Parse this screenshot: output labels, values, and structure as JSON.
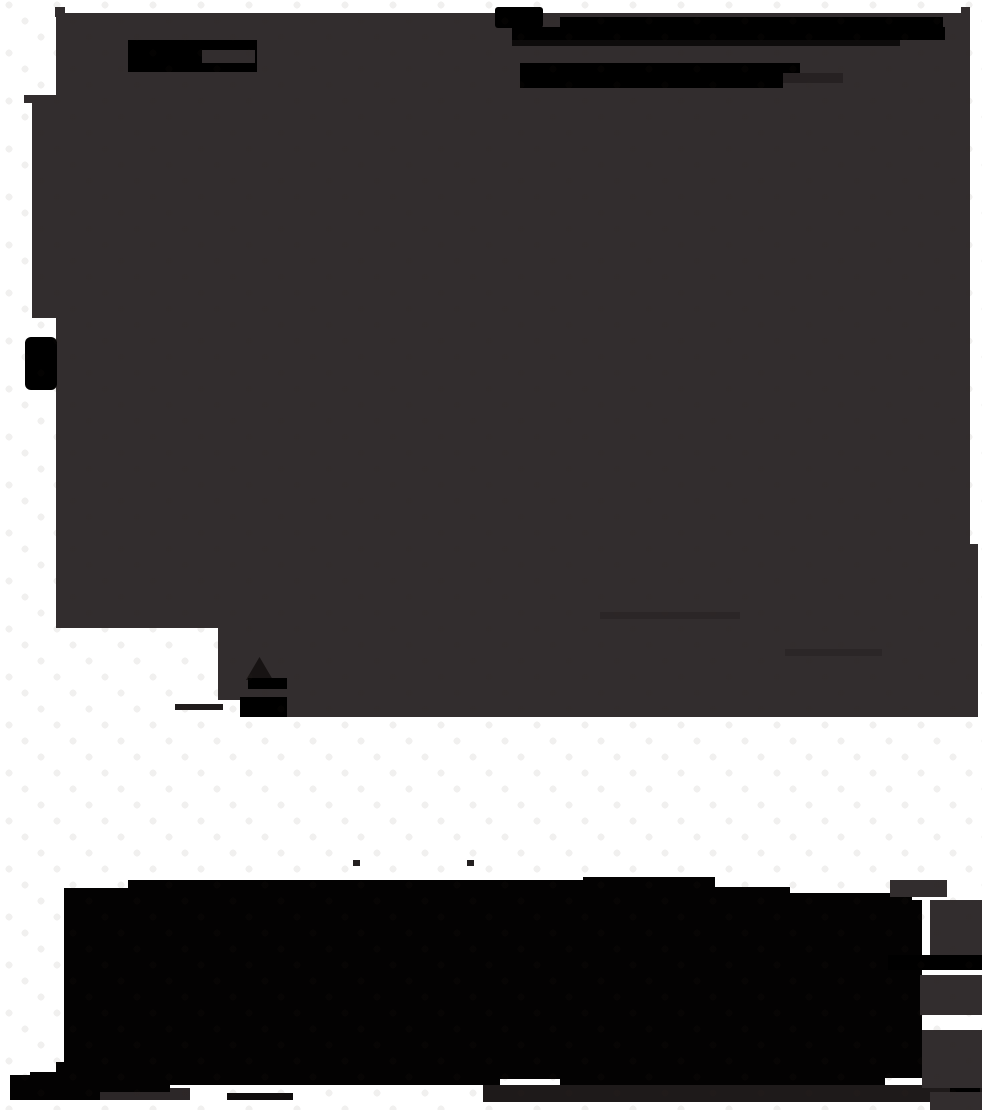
{
  "canvas": {
    "width": 982,
    "height": 1110,
    "background_color": "#ffffff",
    "dot_grid": {
      "cell_width": 48,
      "row_height": 16,
      "dot_diameter": 7,
      "dot_color": "rgba(52,38,26,0.07)"
    }
  },
  "palette": {
    "ink_gray": "#322d2e",
    "ink_black": "#000000",
    "ink_soft_black": "#1e1a1a",
    "canvas_white": "#ffffff"
  },
  "shapes": {
    "rects": [
      {
        "name": "gray-region-main",
        "layer": 1,
        "x": 56,
        "y": 13,
        "w": 914,
        "h": 704,
        "color": "#322d2e"
      },
      {
        "name": "gray-region-right-strip",
        "layer": 1,
        "x": 970,
        "y": 544,
        "w": 8,
        "h": 173,
        "color": "#322d2e"
      },
      {
        "name": "gray-tab-top-right",
        "layer": 1,
        "x": 961,
        "y": 7,
        "w": 9,
        "h": 10,
        "color": "#322d2e"
      },
      {
        "name": "gray-tab-top-left",
        "layer": 1,
        "x": 55,
        "y": 7,
        "w": 10,
        "h": 10,
        "color": "#322d2e"
      },
      {
        "name": "gray-left-strip",
        "layer": 1,
        "x": 32,
        "y": 100,
        "w": 24,
        "h": 218,
        "color": "#322d2e"
      },
      {
        "name": "gray-left-sliver",
        "layer": 1,
        "x": 24,
        "y": 95,
        "w": 32,
        "h": 8,
        "color": "#322d2e"
      },
      {
        "name": "gray-streak-1",
        "layer": 1,
        "x": 600,
        "y": 612,
        "w": 140,
        "h": 7,
        "color": "#2b2627"
      },
      {
        "name": "gray-streak-2",
        "layer": 1,
        "x": 785,
        "y": 649,
        "w": 97,
        "h": 7,
        "color": "#2b2627"
      },
      {
        "name": "white-cutout-bottom-left",
        "layer": 1,
        "x": 56,
        "y": 628,
        "w": 162,
        "h": 89,
        "color": "#ffffff"
      },
      {
        "name": "white-cutout-bottom-left-2",
        "layer": 1,
        "x": 218,
        "y": 700,
        "w": 22,
        "h": 17,
        "color": "#ffffff"
      },
      {
        "name": "gray-underfoot-strip",
        "layer": 1,
        "x": 10,
        "y": 1088,
        "w": 180,
        "h": 12,
        "color": "#2c2728"
      },
      {
        "name": "black-block-top-left",
        "layer": 2,
        "x": 128,
        "y": 40,
        "w": 129,
        "h": 32,
        "color": "#000000"
      },
      {
        "name": "gray-window-in-block",
        "layer": 2,
        "x": 202,
        "y": 50,
        "w": 53,
        "h": 13,
        "color": "#322d2e"
      },
      {
        "name": "black-chunk-top",
        "layer": 2,
        "x": 495,
        "y": 7,
        "w": 48,
        "h": 21,
        "color": "#000000",
        "r": 3
      },
      {
        "name": "black-bar-top-1",
        "layer": 2,
        "x": 560,
        "y": 17,
        "w": 383,
        "h": 11,
        "color": "#000000"
      },
      {
        "name": "black-bar-top-2",
        "layer": 2,
        "x": 512,
        "y": 27,
        "w": 433,
        "h": 13,
        "color": "#000000"
      },
      {
        "name": "black-bar-top-3",
        "layer": 2,
        "x": 512,
        "y": 40,
        "w": 388,
        "h": 6,
        "color": "#0d0b0b"
      },
      {
        "name": "black-bar-mid-1",
        "layer": 2,
        "x": 520,
        "y": 63,
        "w": 280,
        "h": 11,
        "color": "#000000"
      },
      {
        "name": "black-bar-mid-2",
        "layer": 2,
        "x": 520,
        "y": 74,
        "w": 263,
        "h": 14,
        "color": "#000000"
      },
      {
        "name": "dark-ext-mid",
        "layer": 2,
        "x": 783,
        "y": 73,
        "w": 60,
        "h": 10,
        "color": "#262122"
      },
      {
        "name": "black-tab-left-edge",
        "layer": 2,
        "x": 25,
        "y": 337,
        "w": 32,
        "h": 53,
        "color": "#000000",
        "r": 6
      },
      {
        "name": "dark-triangle-mark",
        "layer": 2,
        "x": 246,
        "y": 657,
        "w": 27,
        "h": 23,
        "color": "#171313",
        "clip": "polygon(50% 0, 100% 100%, 0 100%)"
      },
      {
        "name": "black-bar-glyph-1",
        "layer": 2,
        "x": 248,
        "y": 678,
        "w": 39,
        "h": 11,
        "color": "#000000"
      },
      {
        "name": "black-bar-glyph-2",
        "layer": 2,
        "x": 240,
        "y": 697,
        "w": 47,
        "h": 20,
        "color": "#000000"
      },
      {
        "name": "dark-line-glyph",
        "layer": 2,
        "x": 175,
        "y": 704,
        "w": 48,
        "h": 6,
        "color": "#201c1c"
      },
      {
        "name": "bottom-dark-bar",
        "layer": 2,
        "x": 483,
        "y": 1085,
        "w": 499,
        "h": 17,
        "color": "#1e1a1a"
      },
      {
        "name": "black-end-block",
        "layer": 2,
        "x": 950,
        "y": 1075,
        "w": 30,
        "h": 25,
        "color": "#000000"
      },
      {
        "name": "black-dash-bottom-left",
        "layer": 2,
        "x": 227,
        "y": 1093,
        "w": 66,
        "h": 7,
        "color": "#100d0d"
      },
      {
        "name": "speck-above-blob-1",
        "layer": 2,
        "x": 353,
        "y": 860,
        "w": 7,
        "h": 6,
        "color": "#242020"
      },
      {
        "name": "speck-above-blob-2",
        "layer": 2,
        "x": 467,
        "y": 860,
        "w": 7,
        "h": 6,
        "color": "#242020"
      },
      {
        "name": "gray-patch-right-1",
        "layer": 2,
        "x": 890,
        "y": 880,
        "w": 57,
        "h": 17,
        "color": "#322d2e"
      },
      {
        "name": "gray-patch-right-2",
        "layer": 2,
        "x": 930,
        "y": 900,
        "w": 52,
        "h": 55,
        "color": "#322d2e"
      },
      {
        "name": "black-bar-right-edge",
        "layer": 2,
        "x": 888,
        "y": 955,
        "w": 94,
        "h": 15,
        "color": "#000000"
      },
      {
        "name": "gray-patch-right-3",
        "layer": 2,
        "x": 920,
        "y": 975,
        "w": 62,
        "h": 40,
        "color": "#322d2e"
      },
      {
        "name": "gray-patch-right-4",
        "layer": 2,
        "x": 922,
        "y": 1030,
        "w": 60,
        "h": 58,
        "color": "#322d2e"
      },
      {
        "name": "gray-patch-right-5",
        "layer": 2,
        "x": 930,
        "y": 1092,
        "w": 52,
        "h": 18,
        "color": "#322d2e"
      }
    ],
    "polygons": [
      {
        "name": "bottom-ink-blob",
        "color": "#030202",
        "points": "64,888 128,888 128,880 583,880 583,877 715,877 715,887 790,887 790,893 912,893 912,900 922,900 922,1078 885,1078 885,1085 560,1085 560,1079 500,1079 500,1085 170,1085 170,1092 100,1092 100,1100 10,1100 10,1075 30,1075 30,1072 56,1072 56,1062 64,1062"
      }
    ]
  }
}
